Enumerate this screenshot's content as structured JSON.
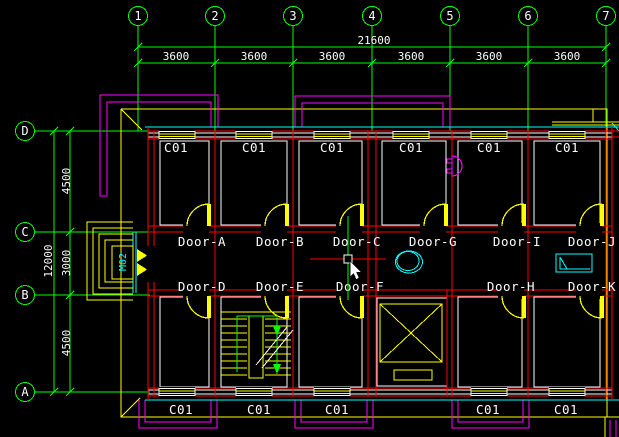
{
  "drawing": {
    "col_bubbles": [
      "1",
      "2",
      "3",
      "4",
      "5",
      "6",
      "7"
    ],
    "row_bubbles": [
      "D",
      "C",
      "B",
      "A"
    ],
    "dims": {
      "total_width": "21600",
      "bays": [
        "3600",
        "3600",
        "3600",
        "3600",
        "3600",
        "3600"
      ],
      "total_height": "12000",
      "rows": [
        "4500",
        "3000",
        "4500"
      ]
    },
    "rooms": {
      "top": [
        "C01",
        "C01",
        "C01",
        "C01",
        "C01",
        "C01"
      ],
      "bottom": [
        "C01",
        "C01",
        "C01",
        "C01",
        "C01"
      ]
    },
    "doors": {
      "top": [
        "Door-A",
        "Door-B",
        "Door-C",
        "Door-G",
        "Door-I",
        "Door-J"
      ],
      "bottom": [
        "Door-D",
        "Door-E",
        "Door-F",
        "Door-H",
        "Door-K"
      ]
    },
    "entrance_label": "M02",
    "colors": {
      "background": "#000000",
      "grid": "#00ff00",
      "walls": "#ff0000",
      "details": "#ffff00",
      "balcony": "#ff00ff",
      "fixtures": "#00ffff",
      "text": "#ffffff"
    }
  }
}
